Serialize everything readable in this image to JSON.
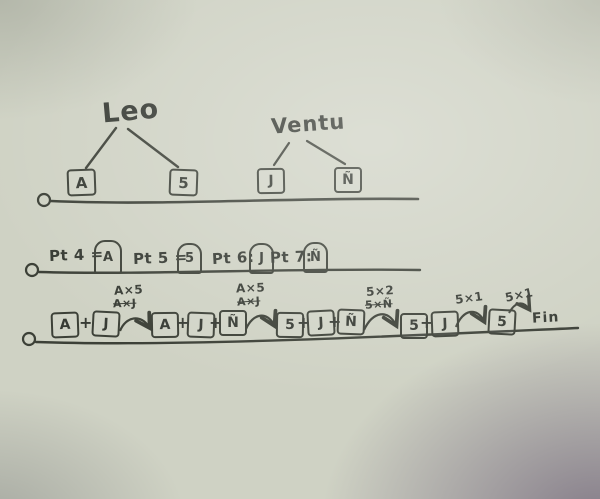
{
  "palette": {
    "paper": "#cfd2c4",
    "ink": "#3c4037",
    "corner_shadow": "#544462"
  },
  "trees": [
    {
      "name": "Leo",
      "left_child": "A",
      "right_child": "5"
    },
    {
      "name": "Ventu",
      "left_child": "J",
      "right_child": "Ñ"
    }
  ],
  "points_row": {
    "items": [
      {
        "label": "Pt 4 =",
        "value": "A"
      },
      {
        "label": "Pt 5 =",
        "value": "5"
      },
      {
        "label": "Pt 6:",
        "value": "J"
      },
      {
        "label": "Pt 7:",
        "value": "Ñ"
      }
    ]
  },
  "sequence_row": {
    "plus": "+",
    "groups": [
      {
        "terms": [
          "A",
          "J"
        ]
      },
      {
        "terms": [
          "A",
          "J",
          "Ñ"
        ]
      },
      {
        "terms": [
          "5",
          "J",
          "Ñ"
        ]
      },
      {
        "terms": [
          "5",
          "J"
        ]
      },
      {
        "terms": [
          "5"
        ]
      }
    ],
    "transitions": [
      {
        "label": "A×5",
        "crossed": "A×J"
      },
      {
        "label": "A×5",
        "crossed": "A×J"
      },
      {
        "label": "5×2",
        "crossed": "5×Ñ"
      },
      {
        "label": "5×1",
        "crossed": ""
      },
      {
        "label": "5×1",
        "crossed": ""
      }
    ],
    "end_label": "Fin"
  }
}
